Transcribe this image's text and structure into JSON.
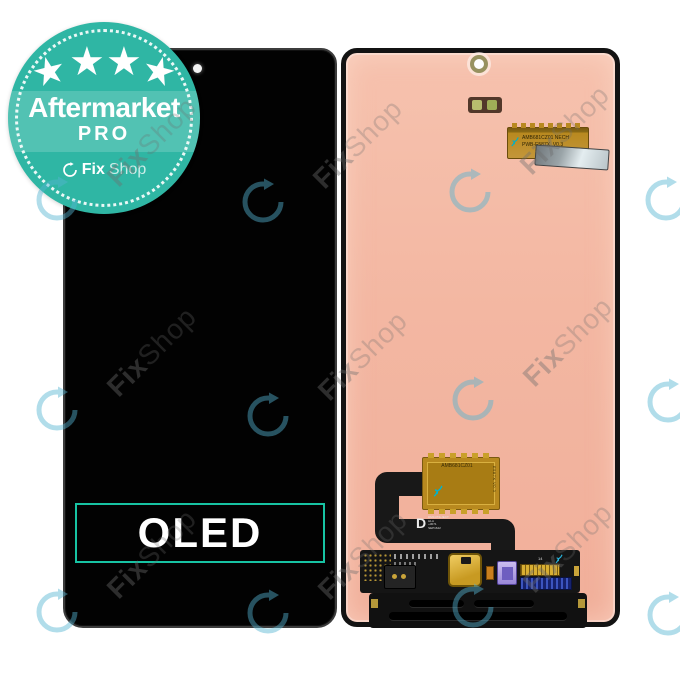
{
  "product": {
    "front_label": "OLED"
  },
  "badge": {
    "star_glyph": "★",
    "star_count": 4,
    "title": "Aftermarket",
    "subtitle": "PRO",
    "logo_bold": "Fix",
    "logo_light": "Shop"
  },
  "watermark": {
    "text_bold": "Fix",
    "text_light": "Shop"
  },
  "labels": {
    "top_flex_lines": "AMB681CZ01 NECH\nPWB-E587X  V0.3",
    "ic_label": "AMB681CZ01",
    "ic_side": "E587X V0.3",
    "d_mark": "D",
    "d_lines": "DM3-PNLJECT\nHLA\n+3071\nSEP1622",
    "pcb_num": "14"
  },
  "colors": {
    "badge_teal": "#2fb6a4",
    "oled_border": "#17c3a3",
    "back_salmon": "#f3b6a2",
    "watermark_blue": "#55b4d2",
    "gold": "#b8891f"
  }
}
